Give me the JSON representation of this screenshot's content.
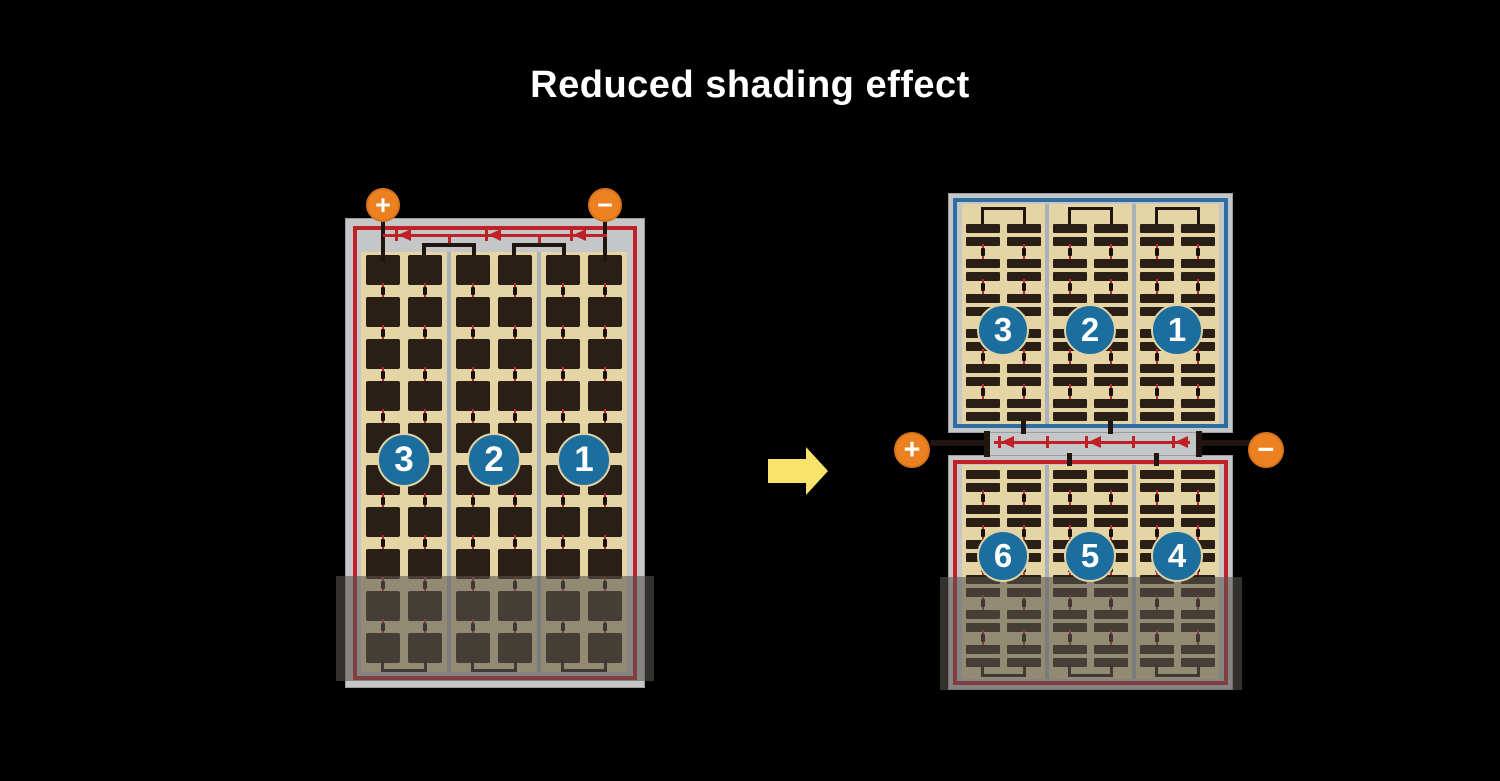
{
  "title": "Reduced shading effect",
  "colors": {
    "background": "#000000",
    "frame": "#c5c6c8",
    "tan": "#e5d4a4",
    "cell_dark": "#2a1f16",
    "wire_red": "#bf2127",
    "wire_blue": "#2e6da4",
    "circle_blue": "#1b6e9e",
    "terminal_orange": "#ec8122",
    "arrow_yellow": "#f8e36b",
    "divider_gray": "#a9b2bb"
  },
  "left_panel": {
    "positive_terminal": "+",
    "negative_terminal": "−",
    "string_numbers": [
      "3",
      "2",
      "1"
    ],
    "bypass_diodes": 3,
    "grid": {
      "type": "full",
      "rows": 10,
      "loop_bottom": true
    }
  },
  "right_panel": {
    "positive_terminal": "+",
    "negative_terminal": "−",
    "bypass_diodes": 3,
    "top_half": {
      "string_numbers": [
        "3",
        "2",
        "1"
      ],
      "grid": {
        "type": "half",
        "rows": 12,
        "top_offset": 20,
        "loop_top": true
      }
    },
    "bottom_half": {
      "string_numbers": [
        "6",
        "5",
        "4"
      ],
      "grid": {
        "type": "half",
        "rows": 12,
        "top_offset": 5,
        "loop_bottom": true
      }
    }
  }
}
